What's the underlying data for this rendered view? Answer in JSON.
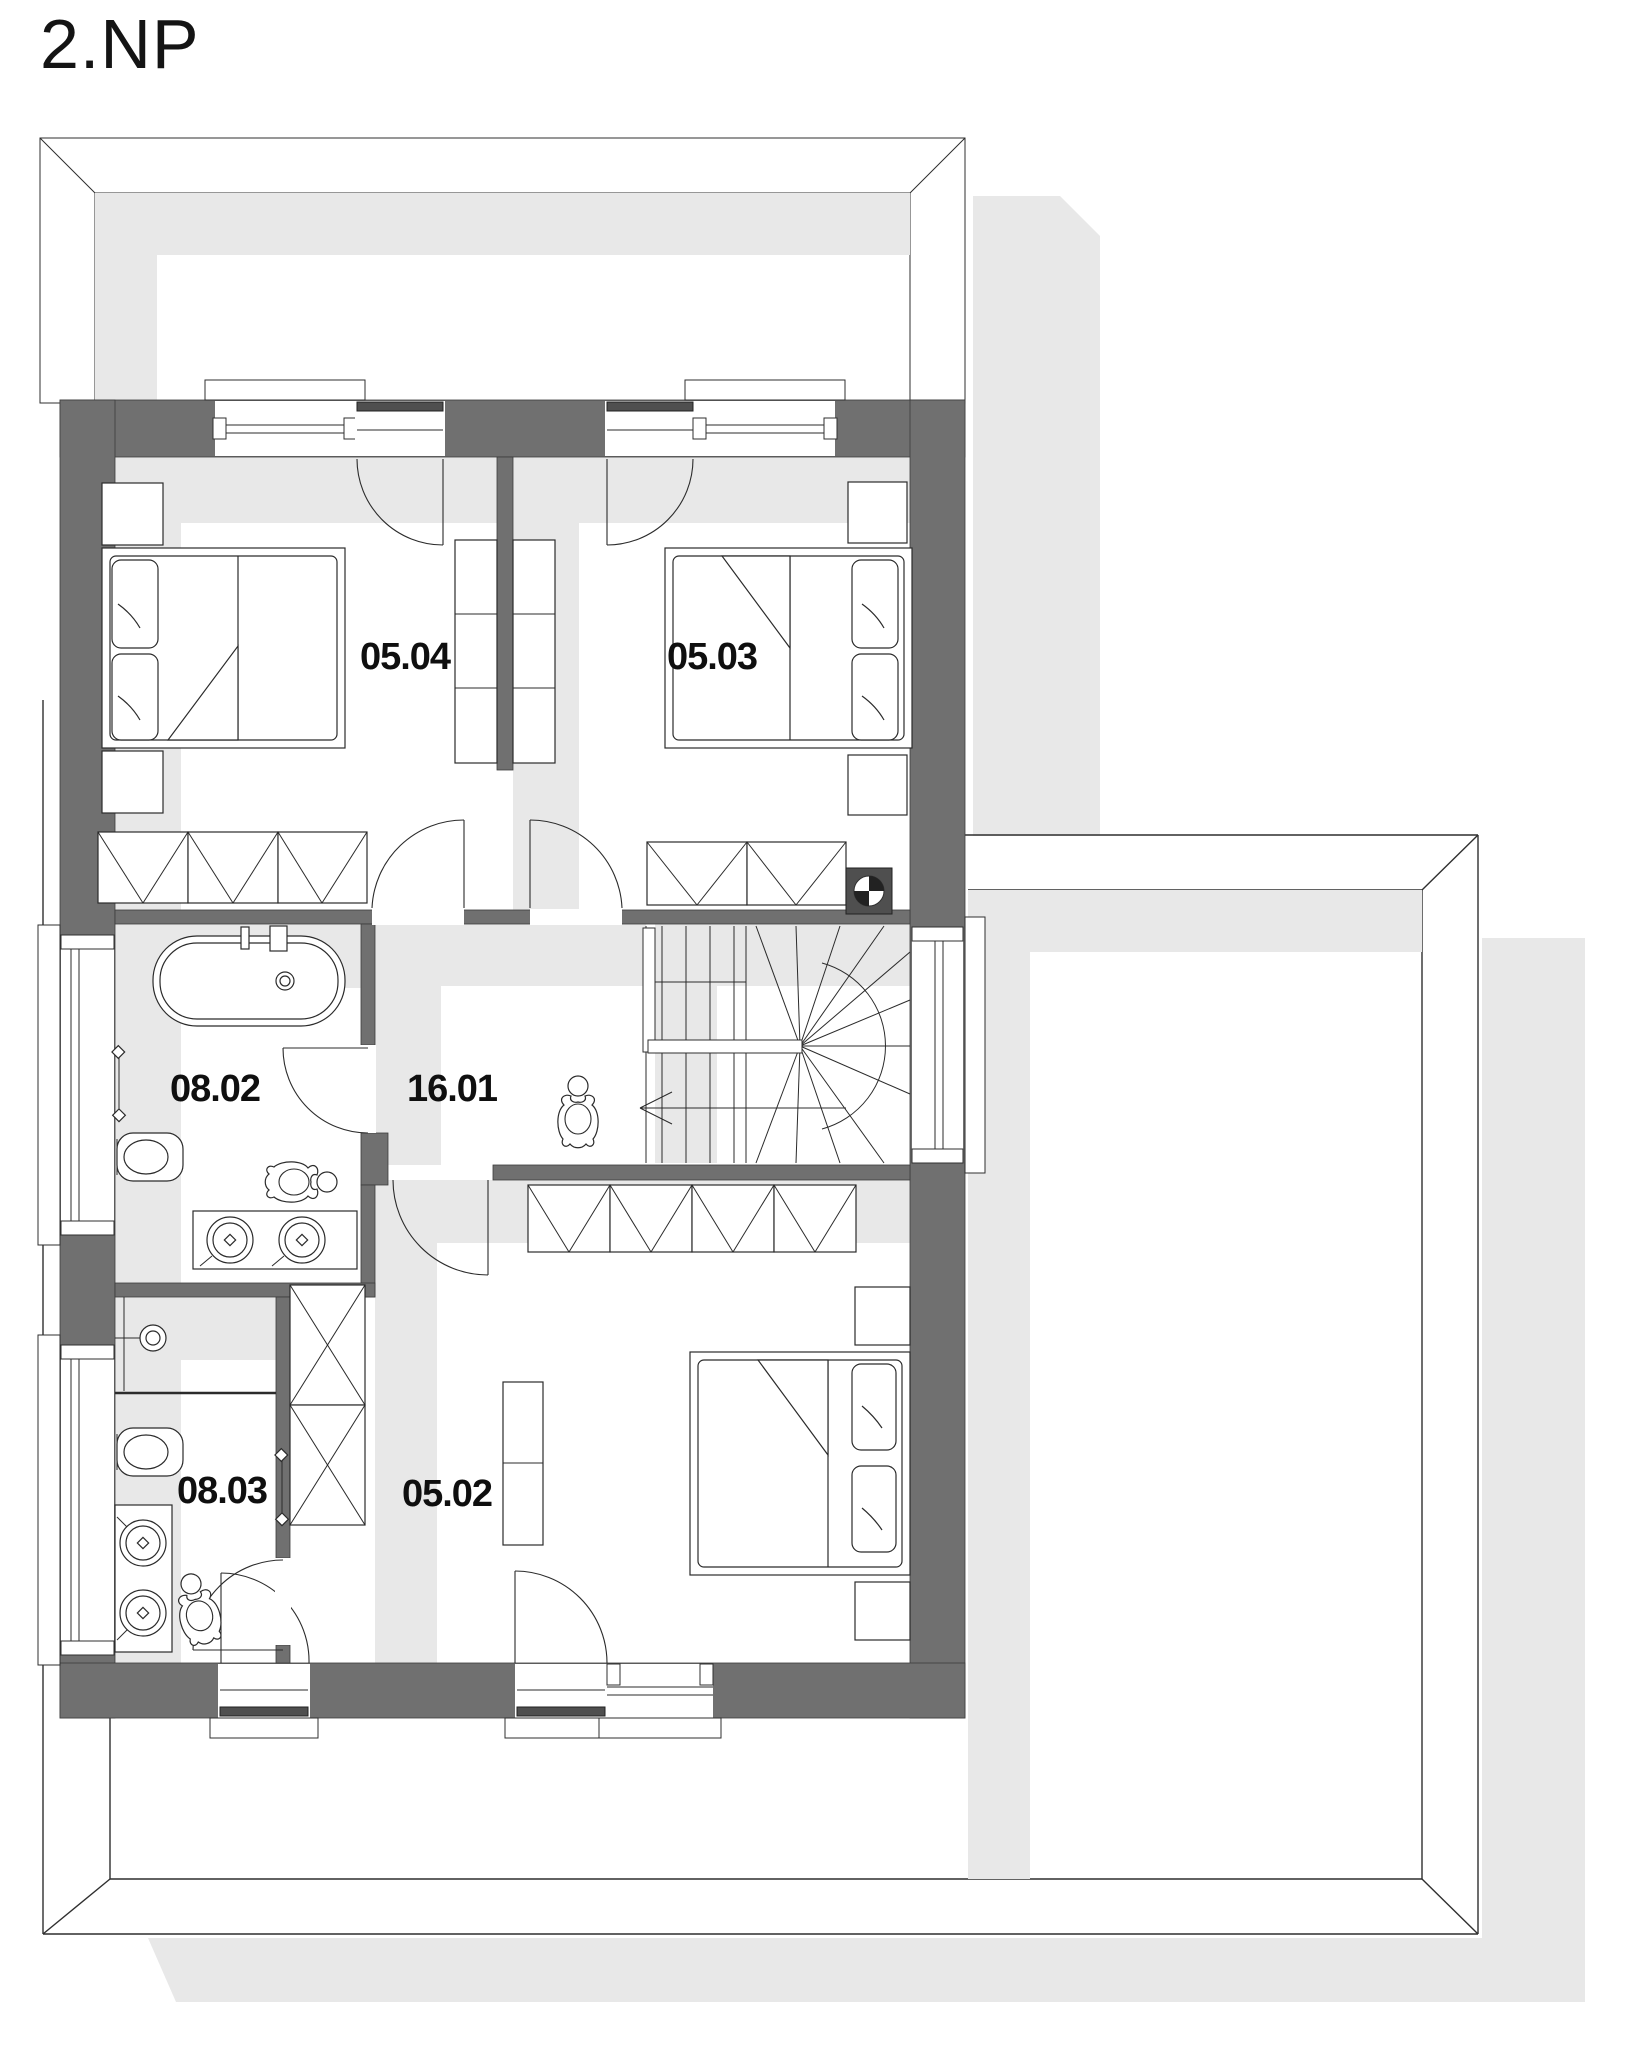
{
  "title": "2.NP",
  "floor_plan": {
    "rooms": [
      {
        "label": "05.04"
      },
      {
        "label": "05.03"
      },
      {
        "label": "08.02"
      },
      {
        "label": "16.01"
      },
      {
        "label": "08.03"
      },
      {
        "label": "05.02"
      }
    ],
    "colors": {
      "wall": "#707070",
      "shadow": "#e8e8e8",
      "outline": "#2f2f2f",
      "background": "#ffffff"
    }
  }
}
